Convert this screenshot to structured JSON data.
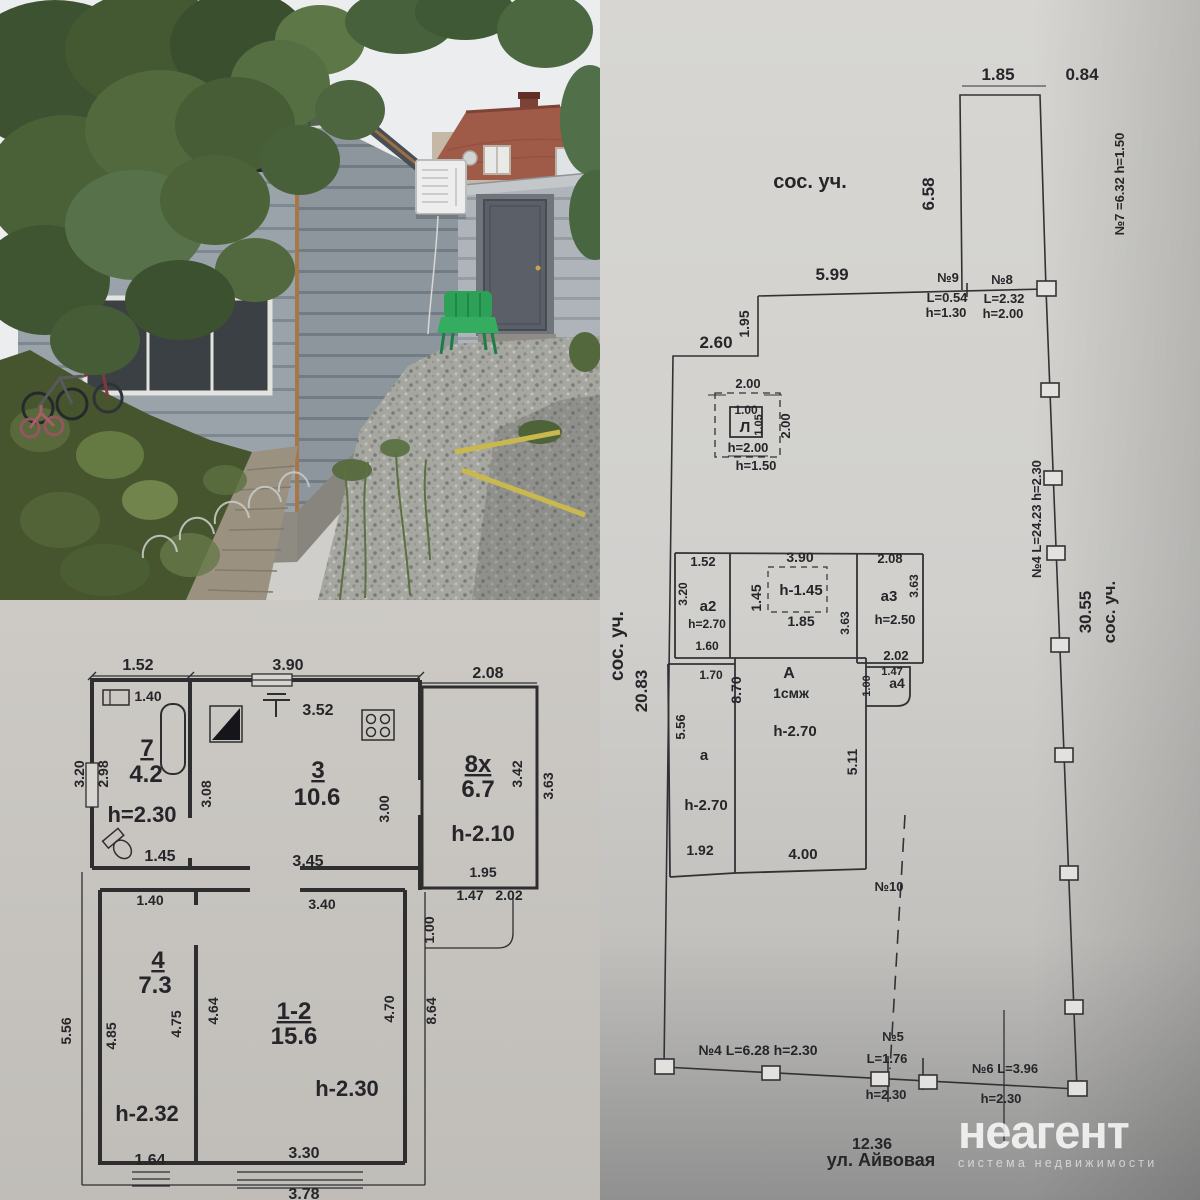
{
  "watermark": {
    "brand": "неагент",
    "tagline": "система недвижимости"
  },
  "colors": {
    "paper_floorplan": "#c9c6c1",
    "paper_siteplan": "#d6d5d1",
    "ink": "#2c2c30",
    "house_siding": "#9aa3aa",
    "gable_green": "#516350",
    "neighbor_roof": "#a05a48",
    "chair_green": "#2ea159",
    "gravel": "#a6a7a0"
  },
  "floor_plan": {
    "labels": [
      {
        "t": "1.52",
        "x": 138,
        "y": 70
      },
      {
        "t": "3.90",
        "x": 288,
        "y": 70
      },
      {
        "t": "2.08",
        "x": 488,
        "y": 78
      },
      {
        "t": "1.40",
        "x": 148,
        "y": 101,
        "s": 14
      },
      {
        "t": "3.52",
        "x": 318,
        "y": 115
      },
      {
        "t": "3.20",
        "x": 84,
        "y": 174,
        "r": -90,
        "s": 14
      },
      {
        "t": "2.98",
        "x": 108,
        "y": 174,
        "r": -90,
        "s": 14
      },
      {
        "t": "7",
        "x": 147,
        "y": 156,
        "s": 24,
        "u": 1
      },
      {
        "t": "4.2",
        "x": 146,
        "y": 182,
        "s": 24
      },
      {
        "t": "h=2.30",
        "x": 142,
        "y": 222,
        "s": 22
      },
      {
        "t": "1.45",
        "x": 160,
        "y": 261
      },
      {
        "t": "3",
        "x": 318,
        "y": 178,
        "s": 24,
        "u": 1
      },
      {
        "t": "10.6",
        "x": 317,
        "y": 205,
        "s": 24
      },
      {
        "t": "3.08",
        "x": 211,
        "y": 194,
        "r": -90,
        "s": 14
      },
      {
        "t": "3.00",
        "x": 389,
        "y": 209,
        "r": -90,
        "s": 14
      },
      {
        "t": "3.45",
        "x": 308,
        "y": 266
      },
      {
        "t": "8x",
        "x": 478,
        "y": 172,
        "s": 24,
        "u": 1
      },
      {
        "t": "6.7",
        "x": 478,
        "y": 197,
        "s": 24
      },
      {
        "t": "h-2.10",
        "x": 483,
        "y": 241,
        "s": 22
      },
      {
        "t": "3.42",
        "x": 522,
        "y": 174,
        "r": -90,
        "s": 14
      },
      {
        "t": "3.63",
        "x": 553,
        "y": 186,
        "r": -90,
        "s": 14
      },
      {
        "t": "1.95",
        "x": 483,
        "y": 277,
        "s": 14
      },
      {
        "t": "1.47",
        "x": 470,
        "y": 300,
        "s": 14
      },
      {
        "t": "2.02",
        "x": 509,
        "y": 300,
        "s": 14
      },
      {
        "t": "1.00",
        "x": 434,
        "y": 330,
        "r": -90,
        "s": 14
      },
      {
        "t": "1.40",
        "x": 150,
        "y": 305,
        "s": 14
      },
      {
        "t": "3.40",
        "x": 322,
        "y": 309,
        "s": 14
      },
      {
        "t": "4",
        "x": 158,
        "y": 368,
        "s": 24,
        "u": 1
      },
      {
        "t": "7.3",
        "x": 155,
        "y": 393,
        "s": 24
      },
      {
        "t": "4.64",
        "x": 218,
        "y": 411,
        "r": -90,
        "s": 14
      },
      {
        "t": "4.75",
        "x": 181,
        "y": 424,
        "r": -90,
        "s": 14
      },
      {
        "t": "4.85",
        "x": 116,
        "y": 436,
        "r": -90,
        "s": 14
      },
      {
        "t": "5.56",
        "x": 71,
        "y": 431,
        "r": -90,
        "s": 14
      },
      {
        "t": "1-2",
        "x": 294,
        "y": 419,
        "s": 24,
        "u": 1
      },
      {
        "t": "15.6",
        "x": 294,
        "y": 444,
        "s": 24
      },
      {
        "t": "4.70",
        "x": 394,
        "y": 409,
        "r": -90,
        "s": 14
      },
      {
        "t": "8.64",
        "x": 436,
        "y": 411,
        "r": -90,
        "s": 14
      },
      {
        "t": "h-2.30",
        "x": 347,
        "y": 496,
        "s": 22
      },
      {
        "t": "h-2.32",
        "x": 147,
        "y": 521,
        "s": 22
      },
      {
        "t": "1.64",
        "x": 150,
        "y": 565
      },
      {
        "t": "3.30",
        "x": 304,
        "y": 558
      },
      {
        "t": "3.78",
        "x": 304,
        "y": 599
      }
    ]
  },
  "site_plan": {
    "labels": [
      {
        "t": "сос. уч.",
        "x": 210,
        "y": 188,
        "s": 20
      },
      {
        "t": "1.85",
        "x": 398,
        "y": 80,
        "s": 17
      },
      {
        "t": "0.84",
        "x": 482,
        "y": 80,
        "s": 17
      },
      {
        "t": "6.58",
        "x": 334,
        "y": 194,
        "r": -90,
        "s": 17
      },
      {
        "t": "№7 =6.32 h=1.50",
        "x": 524,
        "y": 184,
        "r": -90,
        "s": 13
      },
      {
        "t": "5.99",
        "x": 232,
        "y": 280,
        "s": 17
      },
      {
        "t": "№9",
        "x": 348,
        "y": 282,
        "s": 13
      },
      {
        "t": "L=0.54",
        "x": 347,
        "y": 302,
        "s": 13
      },
      {
        "t": "h=1.30",
        "x": 346,
        "y": 317,
        "s": 13
      },
      {
        "t": "№8",
        "x": 402,
        "y": 284,
        "s": 13
      },
      {
        "t": "L=2.32",
        "x": 404,
        "y": 303,
        "s": 13
      },
      {
        "t": "h=2.00",
        "x": 403,
        "y": 318,
        "s": 13
      },
      {
        "t": "1.95",
        "x": 149,
        "y": 324,
        "r": -90,
        "s": 14
      },
      {
        "t": "2.60",
        "x": 116,
        "y": 348,
        "s": 17
      },
      {
        "t": "2.00",
        "x": 148,
        "y": 388,
        "s": 13
      },
      {
        "t": "1.00",
        "x": 146,
        "y": 414,
        "s": 12
      },
      {
        "t": "Л",
        "x": 145,
        "y": 432,
        "s": 15
      },
      {
        "t": "1.05",
        "x": 162,
        "y": 425,
        "r": -90,
        "s": 11
      },
      {
        "t": "2.00",
        "x": 190,
        "y": 426,
        "r": -90,
        "s": 13
      },
      {
        "t": "h=2.00",
        "x": 148,
        "y": 452,
        "s": 13
      },
      {
        "t": "h=1.50",
        "x": 156,
        "y": 470,
        "s": 13
      },
      {
        "t": "1.52",
        "x": 103,
        "y": 566,
        "s": 13
      },
      {
        "t": "3.90",
        "x": 200,
        "y": 562,
        "s": 14
      },
      {
        "t": "2.08",
        "x": 290,
        "y": 563,
        "s": 13
      },
      {
        "t": "3.20",
        "x": 87,
        "y": 594,
        "r": -90,
        "s": 12
      },
      {
        "t": "a2",
        "x": 108,
        "y": 611,
        "s": 15
      },
      {
        "t": "h=2.70",
        "x": 107,
        "y": 628,
        "s": 12
      },
      {
        "t": "1.60",
        "x": 107,
        "y": 650,
        "s": 12
      },
      {
        "t": "1.45",
        "x": 161,
        "y": 598,
        "r": -90,
        "s": 14
      },
      {
        "t": "h-1.45",
        "x": 201,
        "y": 595,
        "s": 15
      },
      {
        "t": "1.85",
        "x": 201,
        "y": 626,
        "s": 14
      },
      {
        "t": "3.63",
        "x": 249,
        "y": 623,
        "r": -90,
        "s": 12
      },
      {
        "t": "a3",
        "x": 289,
        "y": 601,
        "s": 15
      },
      {
        "t": "3.63",
        "x": 318,
        "y": 586,
        "r": -90,
        "s": 12
      },
      {
        "t": "h=2.50",
        "x": 295,
        "y": 624,
        "s": 13
      },
      {
        "t": "2.02",
        "x": 296,
        "y": 660,
        "s": 13
      },
      {
        "t": "1.70",
        "x": 111,
        "y": 679,
        "s": 12
      },
      {
        "t": "8.70",
        "x": 141,
        "y": 690,
        "r": -90,
        "s": 14
      },
      {
        "t": "А",
        "x": 189,
        "y": 678,
        "s": 16
      },
      {
        "t": "1смж",
        "x": 191,
        "y": 698,
        "s": 14
      },
      {
        "t": "h-2.70",
        "x": 195,
        "y": 736,
        "s": 15
      },
      {
        "t": "1.00",
        "x": 270,
        "y": 686,
        "r": -90,
        "s": 11
      },
      {
        "t": "1.47",
        "x": 292,
        "y": 675,
        "s": 11
      },
      {
        "t": "a4",
        "x": 297,
        "y": 688,
        "s": 14
      },
      {
        "t": "5.11",
        "x": 257,
        "y": 762,
        "r": -90,
        "s": 14
      },
      {
        "t": "5.56",
        "x": 85,
        "y": 727,
        "r": -90,
        "s": 13
      },
      {
        "t": "a",
        "x": 104,
        "y": 760,
        "s": 15
      },
      {
        "t": "h-2.70",
        "x": 106,
        "y": 810,
        "s": 15
      },
      {
        "t": "1.92",
        "x": 100,
        "y": 855,
        "s": 14
      },
      {
        "t": "4.00",
        "x": 203,
        "y": 859,
        "s": 15
      },
      {
        "t": "№10",
        "x": 289,
        "y": 891,
        "s": 13
      },
      {
        "t": "сос. уч.",
        "x": 23,
        "y": 646,
        "r": -90,
        "s": 19
      },
      {
        "t": "20.83",
        "x": 47,
        "y": 691,
        "r": -90,
        "s": 17
      },
      {
        "t": "№4 L=24.23 h=2.30",
        "x": 441,
        "y": 519,
        "r": -90,
        "s": 13
      },
      {
        "t": "30.55",
        "x": 491,
        "y": 612,
        "r": -90,
        "s": 17
      },
      {
        "t": "сос. уч.",
        "x": 515,
        "y": 612,
        "r": -90,
        "s": 17
      },
      {
        "t": "№4 L=6.28 h=2.30",
        "x": 158,
        "y": 1055,
        "s": 14
      },
      {
        "t": "№5",
        "x": 293,
        "y": 1041,
        "s": 13
      },
      {
        "t": "L=1.76",
        "x": 287,
        "y": 1063,
        "s": 13
      },
      {
        "t": "h=2.30",
        "x": 286,
        "y": 1099,
        "s": 13
      },
      {
        "t": "№6  L=3.96",
        "x": 405,
        "y": 1073,
        "s": 13
      },
      {
        "t": "h=2.30",
        "x": 401,
        "y": 1103,
        "s": 13
      },
      {
        "t": "12.36",
        "x": 272,
        "y": 1149,
        "s": 16
      },
      {
        "t": "ул. Айвовая",
        "x": 281,
        "y": 1166,
        "s": 18
      }
    ]
  }
}
